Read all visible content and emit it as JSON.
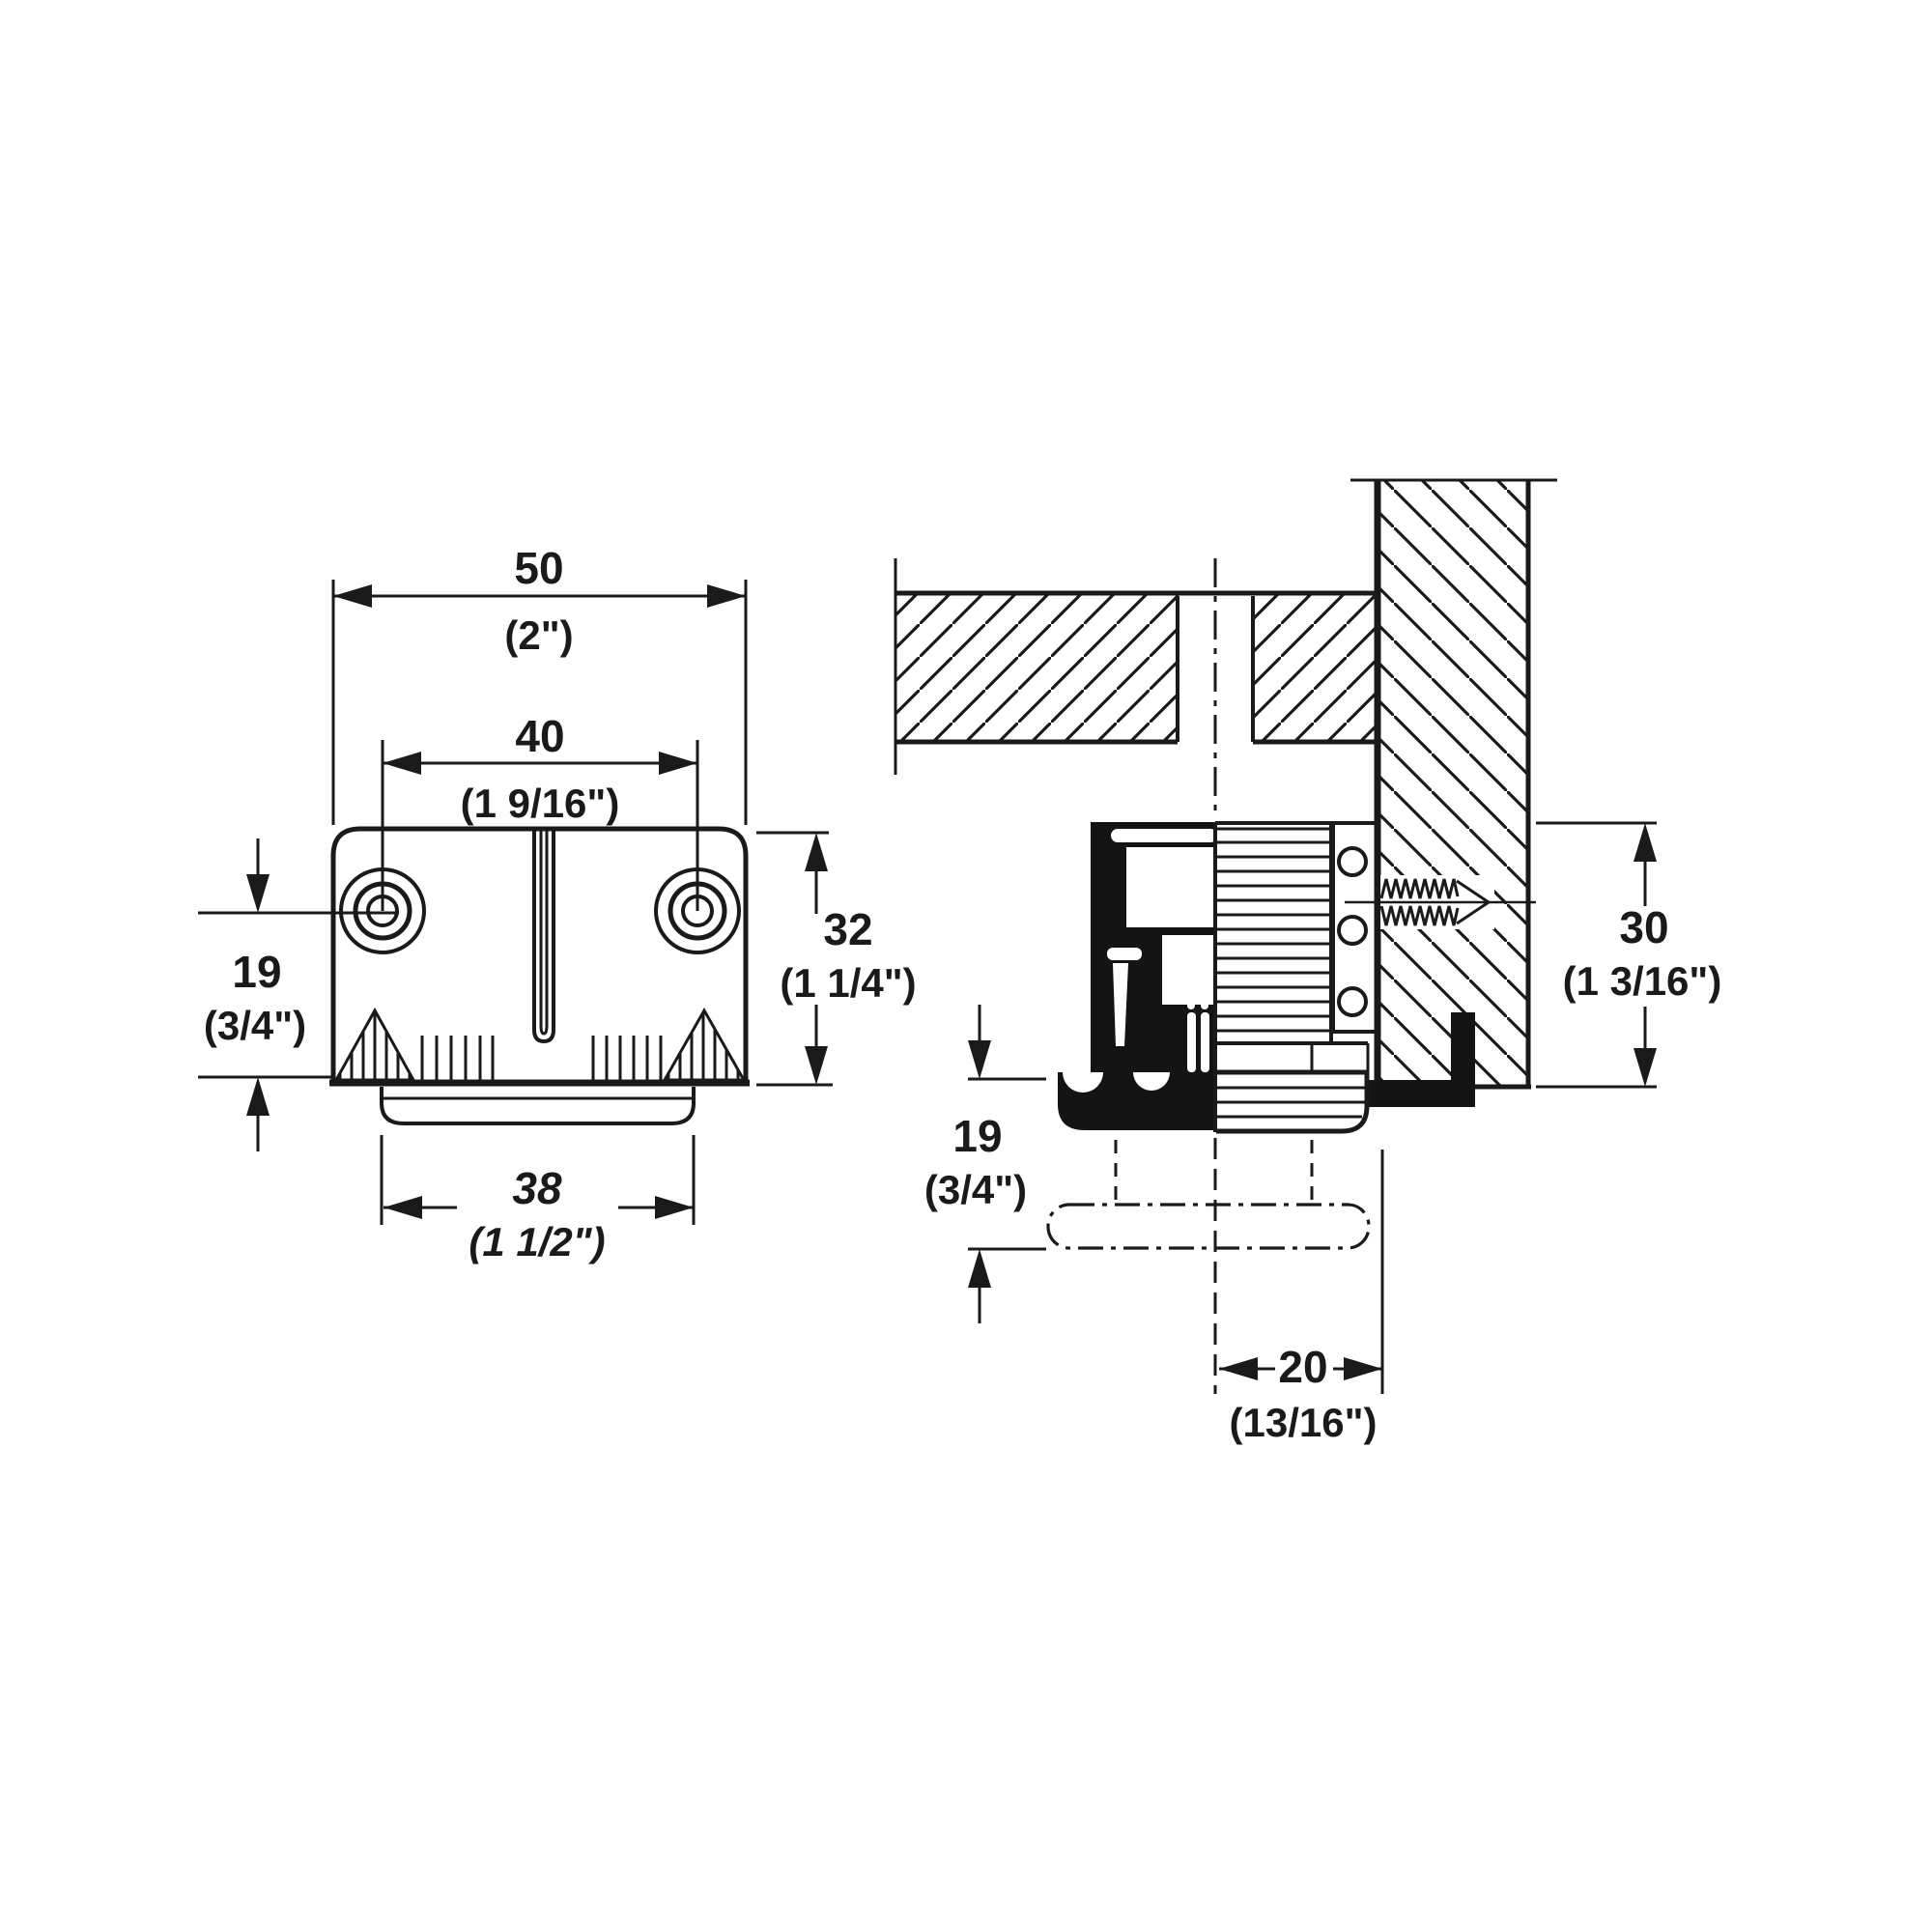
{
  "front_view": {
    "width": {
      "mm": "50",
      "in": "(2\")"
    },
    "hole_spacing": {
      "mm": "40",
      "in": "(1 9/16\")"
    },
    "height": {
      "mm": "32",
      "in": "(1 1/4\")"
    },
    "hole_offset": {
      "mm": "19",
      "in": "(3/4\")"
    },
    "base_width": {
      "mm": "38",
      "in": "(1 1/2\")"
    }
  },
  "section_view": {
    "mount_height": {
      "mm": "30",
      "in": "(1 3/16\")"
    },
    "adjustment_range": {
      "mm": "19",
      "in": "(3/4\")"
    },
    "center_to_wall": {
      "mm": "20",
      "in": "(13/16\")"
    }
  },
  "colors": {
    "line": "#1a1a1a",
    "background": "#ffffff"
  }
}
